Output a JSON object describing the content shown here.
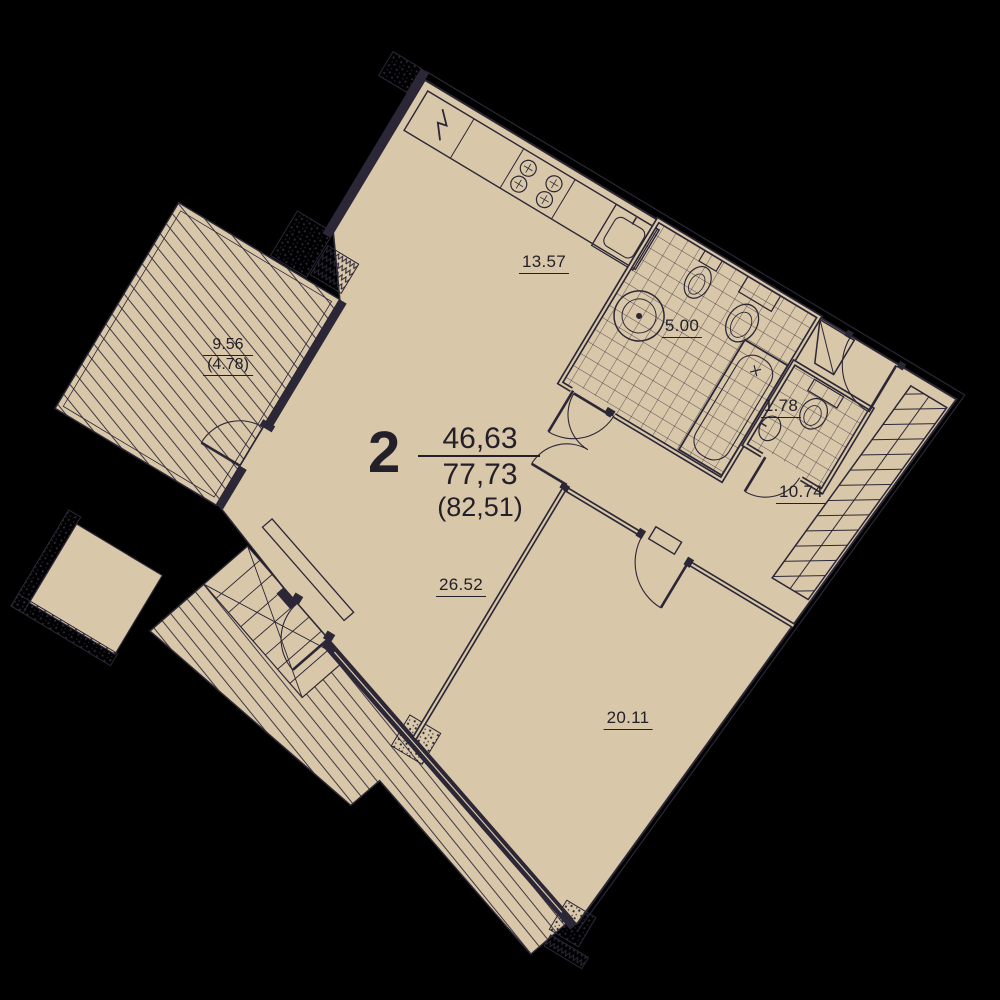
{
  "plan": {
    "summary": {
      "rooms_count": "2",
      "area_living": "46,63",
      "area_total": "77,73",
      "area_total_with_summer": "(82,51)"
    },
    "rooms": {
      "kitchen_living": "13.57",
      "bathroom": "5.00",
      "wc": "1.78",
      "hallway": "10.74",
      "living_room": "26.52",
      "bedroom": "20.11",
      "terrace": "9.56",
      "terrace_reduced": "(4.78)"
    },
    "colors": {
      "background": "#000000",
      "floor": "#d9c7a9",
      "ink": "#2b2737"
    }
  }
}
